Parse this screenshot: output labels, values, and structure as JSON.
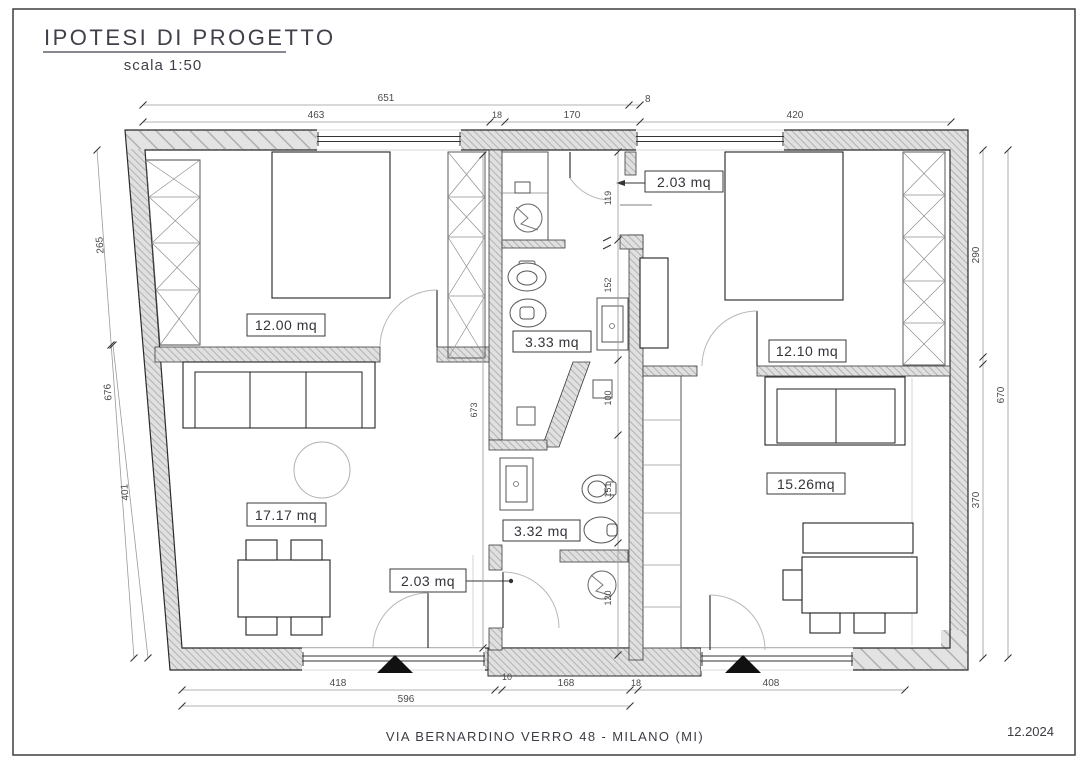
{
  "title": {
    "text": "IPOTESI DI PROGETTO",
    "scale": "scala 1:50"
  },
  "footer": {
    "address": "VIA BERNARDINO VERRO 48 - MILANO (MI)",
    "date": "12.2024"
  },
  "rooms": [
    {
      "id": "bedroom-left",
      "label": "12.00 mq"
    },
    {
      "id": "entry-top",
      "label": "2.03 mq"
    },
    {
      "id": "bathroom-top",
      "label": "3.33 mq"
    },
    {
      "id": "bedroom-right",
      "label": "12.10 mq"
    },
    {
      "id": "living-left",
      "label": "17.17 mq"
    },
    {
      "id": "bathroom-bottom",
      "label": "3.32 mq"
    },
    {
      "id": "living-right",
      "label": "15.26mq"
    },
    {
      "id": "hallway-bottom",
      "label": "2.03 mq"
    }
  ],
  "dimensions": {
    "top_row1": [
      "651",
      "8"
    ],
    "top_row2": [
      "463",
      "18",
      "170",
      "420"
    ],
    "bottom_row1": [
      "418",
      "10",
      "168",
      "18",
      "408"
    ],
    "bottom_row2": [
      "596"
    ],
    "left": [
      "265",
      "676",
      "401"
    ],
    "right": [
      "290",
      "670",
      "370"
    ],
    "interior": [
      "119",
      "152",
      "100",
      "151",
      "120",
      "673"
    ]
  }
}
